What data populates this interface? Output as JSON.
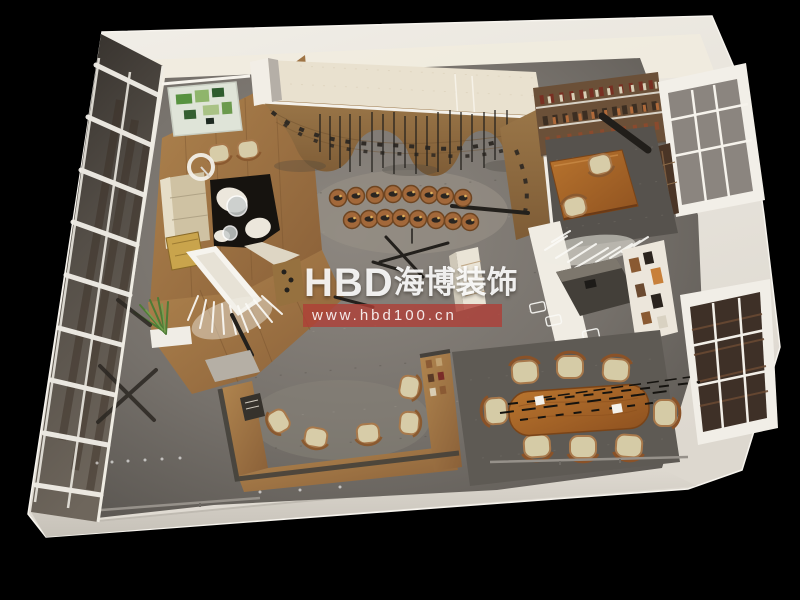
{
  "meta": {
    "type": "3d-interior-rendering",
    "view": "top-down birds-eye axonometric",
    "subject": "retail shoe showroom and office interior design rendering",
    "background_color": "#000000"
  },
  "watermark": {
    "brand": "HBD海博装饰",
    "brand_latin": "HBD",
    "brand_cjk": "海博装饰",
    "url": "www.hbd100.cn",
    "brand_color": "#ffffff",
    "banner_color": "#af3e36"
  },
  "palette": {
    "background": "#000000",
    "building_shell": "#e9e5dd",
    "concrete_floor": "#7e7974",
    "wood_floor": "#a87c4e",
    "display_wood": "#8f6c42",
    "conference_table_wood": "#b06a2a",
    "cushion_beige": "#d7cca8",
    "rug_dark": "#5c5853",
    "glass_facade": "#4a443e",
    "accent_red": "#af3e36"
  },
  "scene": {
    "regions": [
      {
        "name": "glass-curtain-wall",
        "label": "glass curtain wall facade with white mullions"
      },
      {
        "name": "lounge",
        "label": "lounge: sofa, armchairs, cowhide rug, floor lamp"
      },
      {
        "name": "wall-art",
        "label": "green abstract wall art"
      },
      {
        "name": "shoe-display-wall",
        "label": "curved wood shoe display wall with rods"
      },
      {
        "name": "pedestal-display",
        "label": "log pedestal shoe display, two rows"
      },
      {
        "name": "bookshelf-wall",
        "label": "bookshelf wall"
      },
      {
        "name": "office-area",
        "label": "wood desk with two chairs on dark rug"
      },
      {
        "name": "window-bays",
        "label": "white framed window bays on right wall"
      },
      {
        "name": "styling-nook",
        "label": "styling nook with white branch decor and dark counter"
      },
      {
        "name": "conference-area",
        "label": "oval wood conference table with eight chairs and linear chandelier"
      },
      {
        "name": "bar-area",
        "label": "U-shaped wood bar counter with five stools"
      },
      {
        "name": "entry-ramp",
        "label": "white wedge ramp with fringe decor"
      },
      {
        "name": "plant",
        "label": "potted plant"
      }
    ]
  }
}
